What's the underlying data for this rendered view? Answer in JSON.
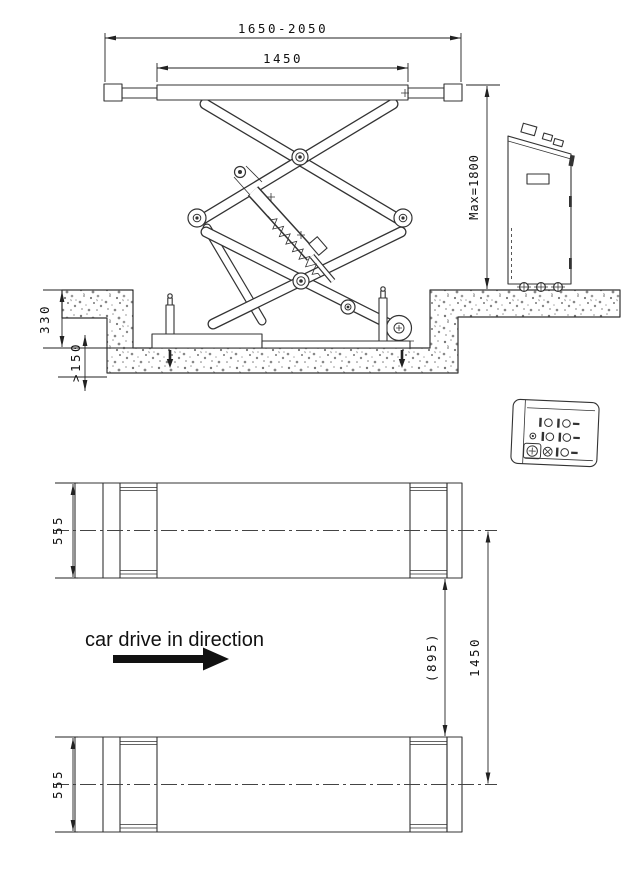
{
  "colors": {
    "background": "#ffffff",
    "line": "#333333",
    "dimension": "#222222",
    "text": "#111111",
    "concrete_speckle": "#777777"
  },
  "side_view": {
    "dimensions": {
      "overall_length": "1650-2050",
      "platform_length": "1450",
      "max_lift_height": "Max=1800",
      "pit_depth": "330",
      "foundation_min_depth": ">150"
    }
  },
  "plan_view": {
    "dimensions": {
      "front_platform_width": "555",
      "rear_platform_width": "555",
      "platform_inner_gap": "(895)",
      "platform_center_distance": "1450"
    },
    "drive_direction_label": "car drive in direction"
  }
}
